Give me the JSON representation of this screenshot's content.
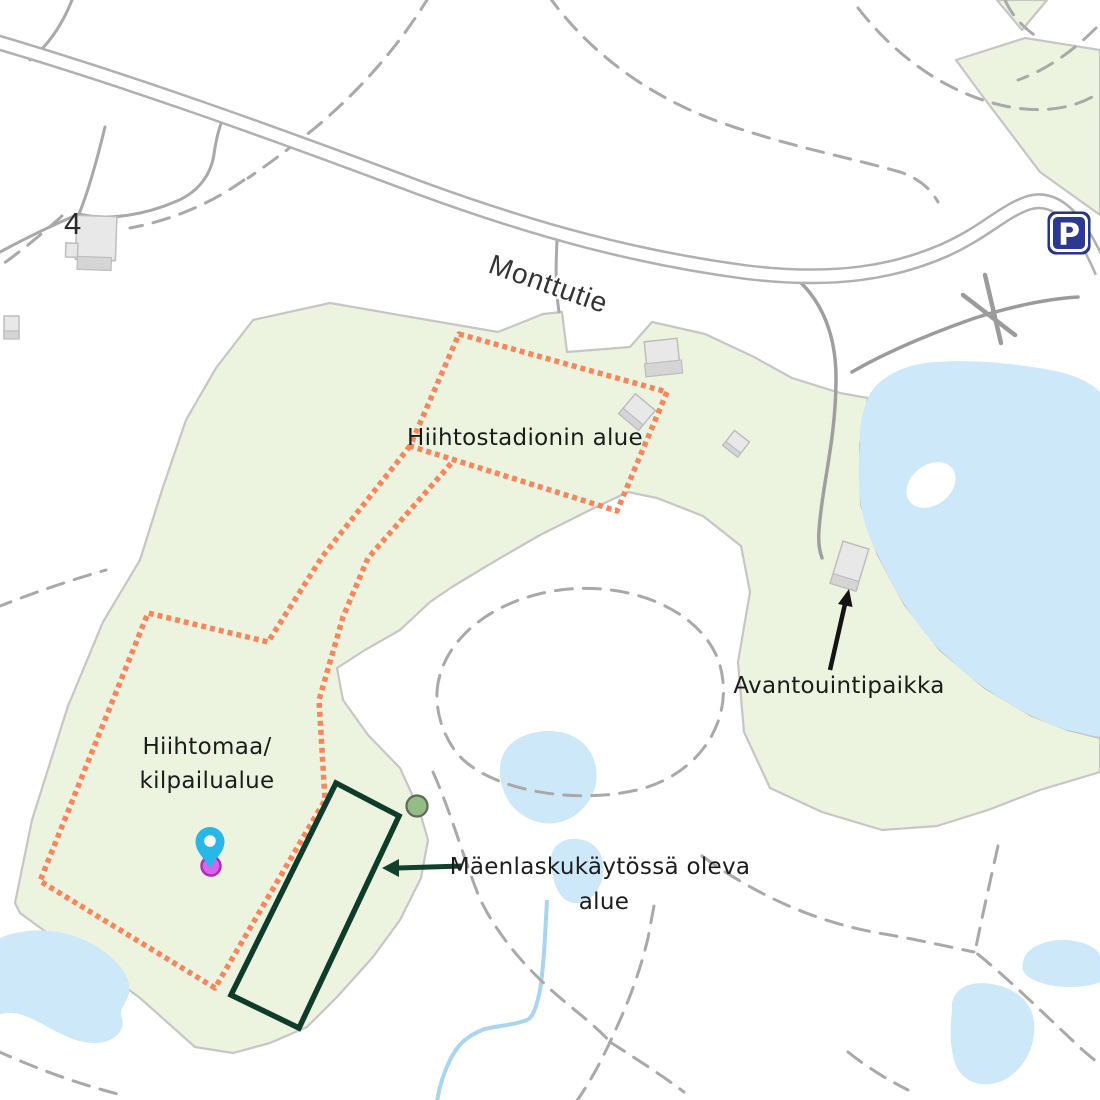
{
  "map": {
    "road_label": "Monttutie",
    "house_number": "4",
    "parking_sign_letter": "P",
    "areas": {
      "ski_stadium_label": "Hiihtostadionin alue",
      "competition_area_line1": "Hiihtomaa/",
      "competition_area_line2": "kilpailualue",
      "ice_swimming_label": "Avantouintipaikka",
      "sledding_area_line1": "Mäenlaskukäytössä oleva",
      "sledding_area_line2": "alue"
    },
    "icons": [
      {
        "name": "parking-icon",
        "meaning": "parking area",
        "glyph": "P"
      },
      {
        "name": "location-pin-icon",
        "meaning": "current location marker"
      },
      {
        "name": "trail-marker-dot",
        "meaning": "small green point marker"
      }
    ],
    "colors": {
      "area_green": "#ecf4df",
      "boundary_dotted_orange": "#f8855c",
      "sledding_outline_dark_green": "#0f3c2a",
      "water_blue": "#cde8f8",
      "stream_blue": "#a9d5ef",
      "road_fill": "#ffffff",
      "road_casing": "#b0b0b0",
      "trail_gray": "#a9a9a9",
      "pin_blue": "#29b6e9",
      "pin_magenta": "#d964e6",
      "marker_green": "#93bd85",
      "parking_sign_blue": "#2b3990",
      "label_text": "#1c1c1c"
    }
  }
}
